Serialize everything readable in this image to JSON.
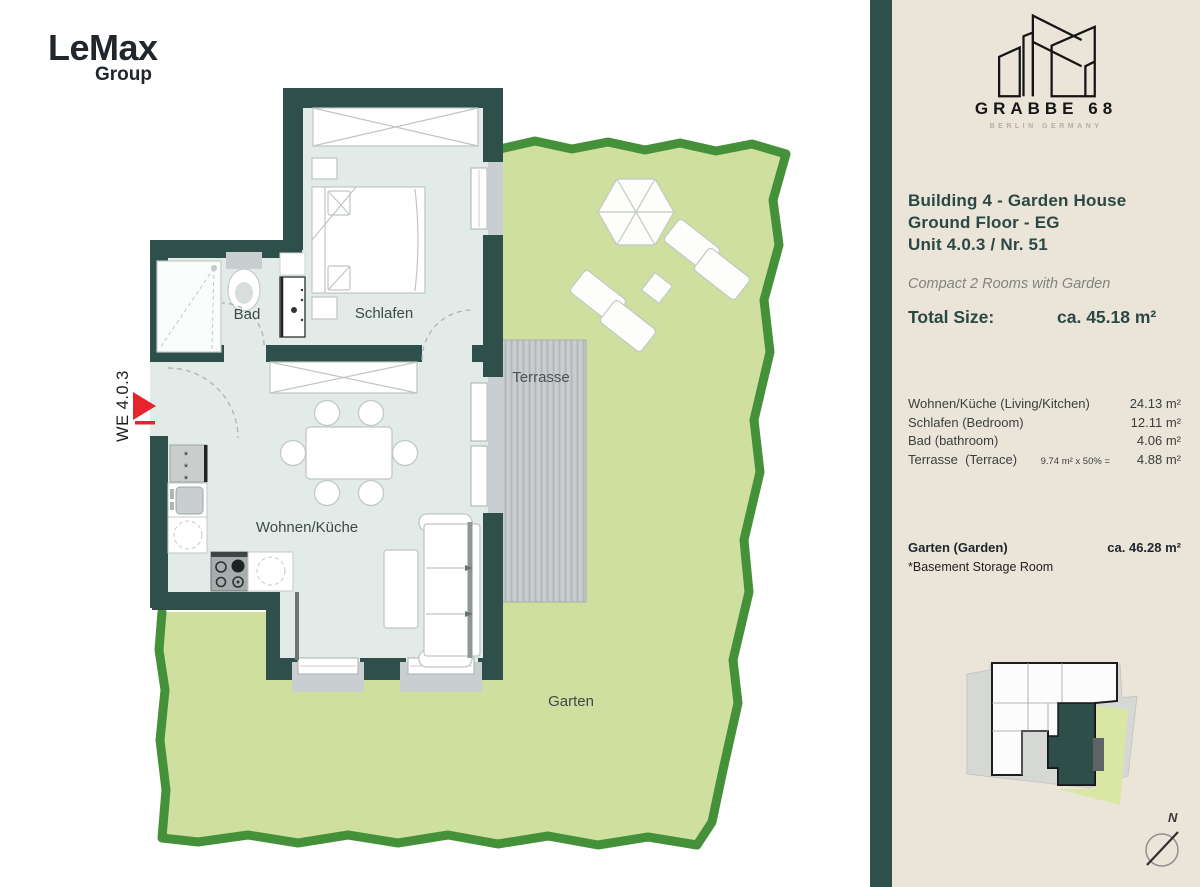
{
  "branding": {
    "name": "LeMax",
    "sub": "Group"
  },
  "project": {
    "name": "GRABBE 68",
    "tagline": "BERLIN GERMANY"
  },
  "unit_info": {
    "line1": "Building 4 - Garden House",
    "line2": "Ground Floor - EG",
    "line3": "Unit 4.0.3 / Nr. 51",
    "subtitle": "Compact 2 Rooms with Garden",
    "total_label": "Total Size:",
    "total_value": "ca. 45.18 m²"
  },
  "area_table": {
    "rows": [
      {
        "label": "Wohnen/Küche (Living/Kitchen)",
        "note": "",
        "value": "24.13 m²"
      },
      {
        "label": "Schlafen (Bedroom)",
        "note": "",
        "value": "12.11 m²"
      },
      {
        "label": "Bad (bathroom)",
        "note": "",
        "value": "4.06 m²"
      },
      {
        "label": "Terrasse  (Terrace)",
        "note": "9.74 m² x 50% =",
        "value": "4.88 m²"
      }
    ],
    "garden_label": "Garten (Garden)",
    "garden_value": "ca. 46.28 m²",
    "footnote": "*Basement Storage Room"
  },
  "floor_plan": {
    "labels": {
      "bathroom": "Bad",
      "bedroom": "Schlafen",
      "living": "Wohnen/Küche",
      "terrace": "Terrasse",
      "garden": "Garten"
    },
    "unit_tag": "WE 4.0.3"
  },
  "compass": {
    "north": "N"
  },
  "colors": {
    "wall": "#2F4F4B",
    "floor": "#E3EBE8",
    "garden_fill": "#CEDF9F",
    "garden_border": "#44913A",
    "terrace": "#C9CDCE",
    "panel": "#EAE4D9",
    "heading": "#2B4845",
    "accent_red": "#E5252B"
  }
}
